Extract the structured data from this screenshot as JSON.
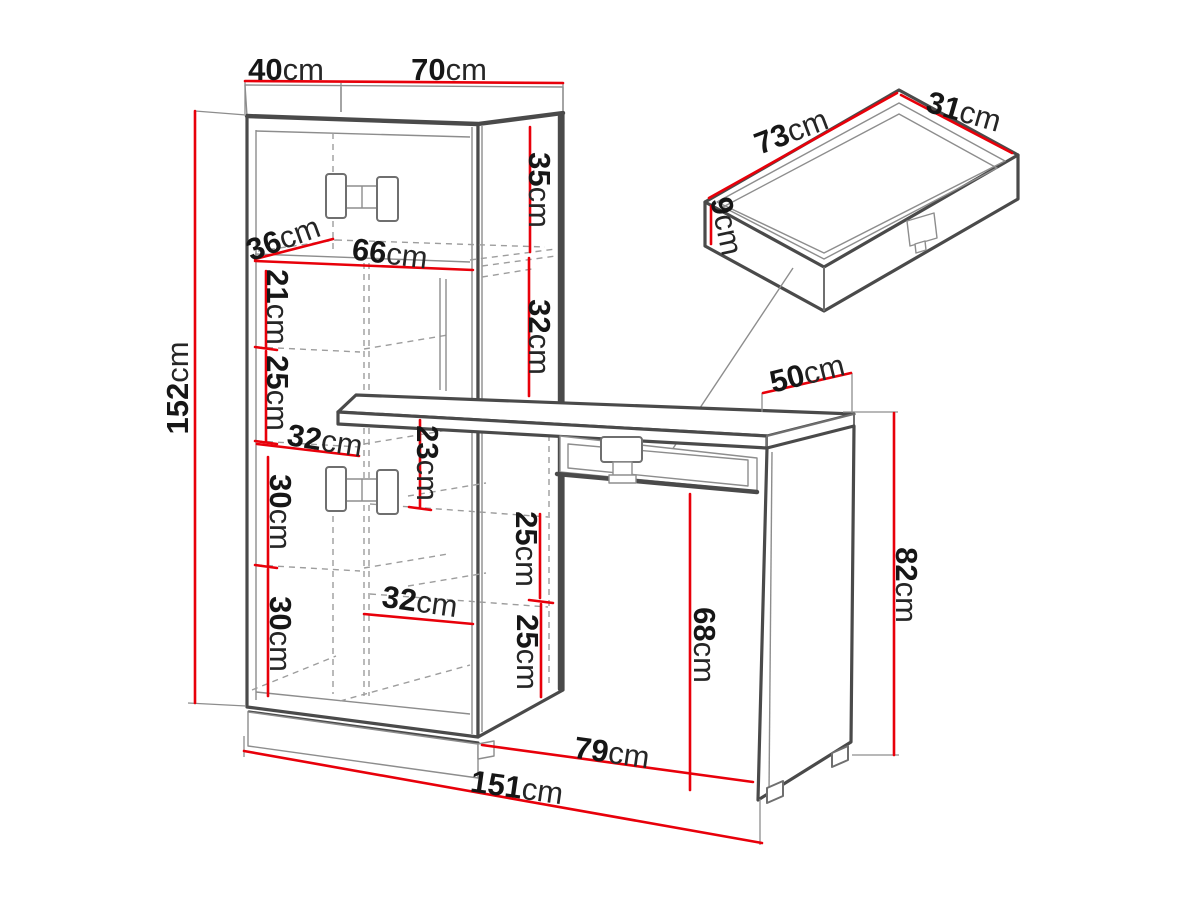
{
  "figure": {
    "kind": "furniture-dimension-diagram",
    "subject": "desk with shelving cabinet and pull-out drawer detail",
    "unit": "cm",
    "colors": {
      "dimension": "#e8000a",
      "outline": "#4a4a4a",
      "hidden_lines": "#9d9d9d",
      "text": "#161616",
      "background": "#ffffff"
    }
  },
  "dims": {
    "top_depth": {
      "value": "40",
      "unit": "cm"
    },
    "top_width": {
      "value": "70",
      "unit": "cm"
    },
    "total_height": {
      "value": "152",
      "unit": "cm"
    },
    "top_section_height": {
      "value": "35",
      "unit": "cm"
    },
    "shelf_depth": {
      "value": "36",
      "unit": "cm"
    },
    "shelf_width": {
      "value": "66",
      "unit": "cm"
    },
    "niche_a_height": {
      "value": "21",
      "unit": "cm"
    },
    "niche_b_height": {
      "value": "25",
      "unit": "cm"
    },
    "niche_width": {
      "value": "32",
      "unit": "cm"
    },
    "door_upper_height": {
      "value": "30",
      "unit": "cm"
    },
    "door_lower_height": {
      "value": "30",
      "unit": "cm"
    },
    "under_desk_gap": {
      "value": "23",
      "unit": "cm"
    },
    "side_niche_height": {
      "value": "32",
      "unit": "cm"
    },
    "cube_a_height": {
      "value": "25",
      "unit": "cm"
    },
    "cube_width": {
      "value": "32",
      "unit": "cm"
    },
    "cube_b_height": {
      "value": "25",
      "unit": "cm"
    },
    "desk_depth": {
      "value": "50",
      "unit": "cm"
    },
    "desk_height": {
      "value": "82",
      "unit": "cm"
    },
    "kneehole_height": {
      "value": "68",
      "unit": "cm"
    },
    "desk_width": {
      "value": "79",
      "unit": "cm"
    },
    "total_width": {
      "value": "151",
      "unit": "cm"
    },
    "drawer_width": {
      "value": "73",
      "unit": "cm"
    },
    "drawer_depth": {
      "value": "31",
      "unit": "cm"
    },
    "drawer_height": {
      "value": "9",
      "unit": "cm"
    }
  }
}
